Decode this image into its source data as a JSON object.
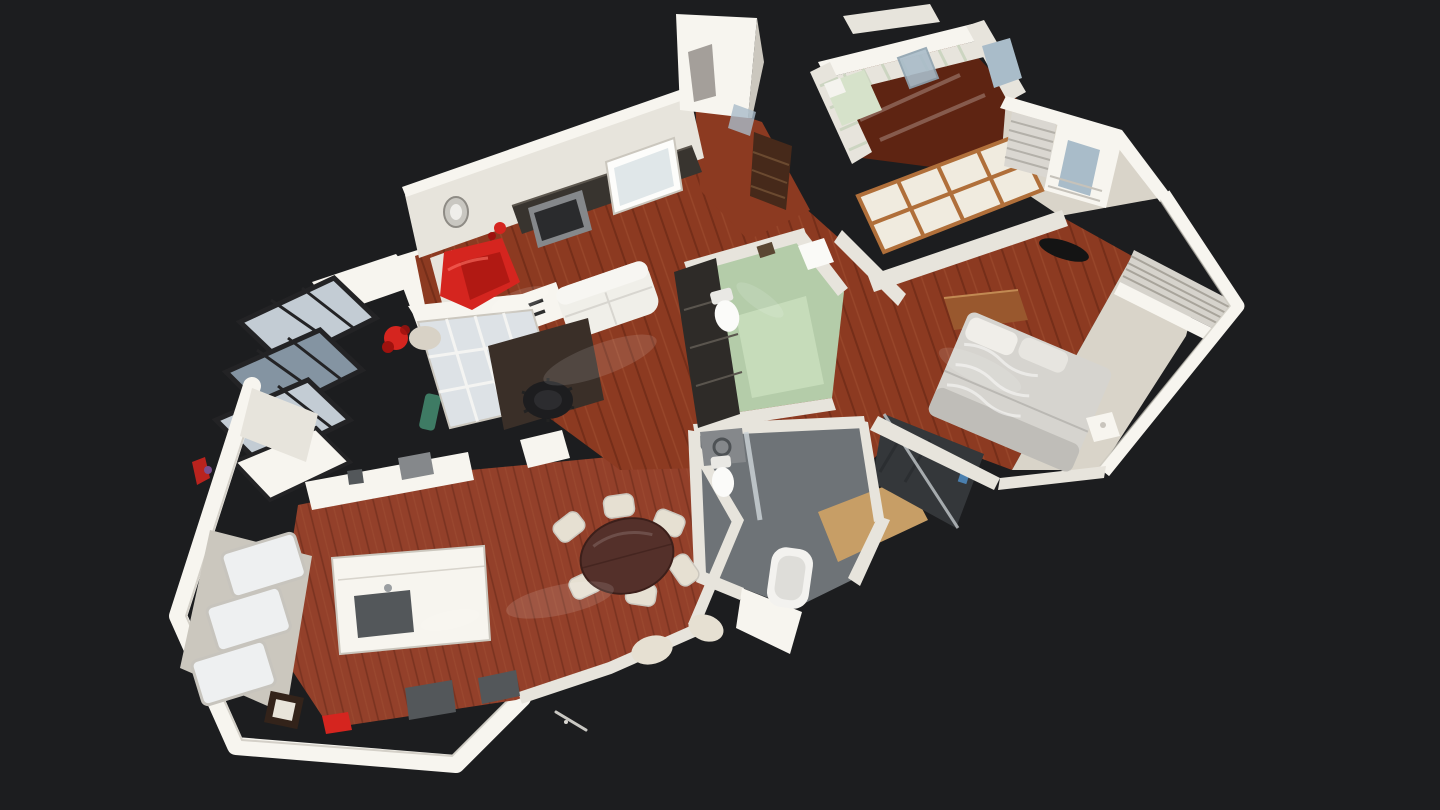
{
  "app": {
    "name": "3D tour viewer",
    "view": "dollhouse-overview"
  },
  "canvas": {
    "width": 1440,
    "height": 810
  },
  "scene": {
    "type": "3d-dollhouse-apartment-scan",
    "description": "Oblique top-down dollhouse view of a photogrammetry-scanned apartment floating on a dark viewer background",
    "palette": {
      "background": "#1c1d1f",
      "wall": "#e7e4dc",
      "wallBright": "#f7f5ef",
      "wallShade": "#cbc7be",
      "wallDark": "#b2aea5",
      "wood": "#8c3a21",
      "woodLight": "#b2603c",
      "woodDark": "#5e2412",
      "herring": "#93402a",
      "paleFloor": "#d9d4c9",
      "greenFloor": "#b4cca9",
      "greenRug": "#c6dcba",
      "tileGray": "#6e7377",
      "tileDark": "#53575b",
      "showerDark": "#34373a",
      "bedGray": "#d6d4cf",
      "bedShade": "#b5b3ae",
      "red": "#d5251f",
      "redDark": "#9e120e",
      "consoleDark": "#38342f",
      "black": "#141414",
      "tableBrown": "#54302a",
      "shojiWood": "#b06f3a",
      "shojiPanel": "#f0ebdf",
      "glassFrame": "#232325",
      "glassPane": "#c3ccd4",
      "glassPaneDark": "#8494a2",
      "skylight": "#eef0f1",
      "lightWood": "#c79e66",
      "stripeGreen": "#c5d1ba",
      "mirror": "#a9bcc9",
      "blinds": "#d6d3cc",
      "blindsLine": "#a8a49b",
      "chairCream": "#e6e0d2",
      "appliance": "#85888b",
      "sink": "#53575a",
      "darkWoodFurn": "#46291a",
      "plantGreen": "#3e7b64"
    },
    "rooms": [
      {
        "id": "living-room",
        "features": [
          "tv-wall",
          "whiteboard",
          "media-console",
          "white-sofa",
          "red-lounge-chair",
          "desk",
          "office-chair",
          "glass-block-partition",
          "wall-clock",
          "red-flowers"
        ]
      },
      {
        "id": "entrance-hall",
        "features": [
          "dark-dresser",
          "mirror"
        ]
      },
      {
        "id": "striped-bedroom",
        "features": [
          "green-striped-walls",
          "bed-green-linen",
          "standing-mirror",
          "glossy-dark-floor"
        ]
      },
      {
        "id": "dressing-room",
        "features": [
          "wardrobe-with-mirror",
          "radiator",
          "shoji-screen"
        ]
      },
      {
        "id": "main-bedroom",
        "features": [
          "double-bed-gray-throw",
          "wood-dresser",
          "tv",
          "venetian-blind-window",
          "nightstand"
        ]
      },
      {
        "id": "green-bathroom",
        "features": [
          "toilet",
          "green-rug",
          "dark-shelf",
          "washbasin"
        ]
      },
      {
        "id": "gray-bathroom",
        "features": [
          "bathtub",
          "toilet",
          "washer",
          "wood-mat",
          "glass-divider"
        ]
      },
      {
        "id": "shower-room",
        "features": [
          "dark-tiled-walk-in-shower"
        ]
      },
      {
        "id": "dining-room",
        "features": [
          "round-table",
          "cream-chairs",
          "herringbone-floor",
          "window-wall"
        ]
      },
      {
        "id": "kitchen",
        "features": [
          "island-with-sink",
          "counters",
          "three-skylights"
        ]
      },
      {
        "id": "conservatory",
        "features": [
          "black-framed-glazing",
          "red-flowers",
          "plant"
        ]
      }
    ]
  }
}
